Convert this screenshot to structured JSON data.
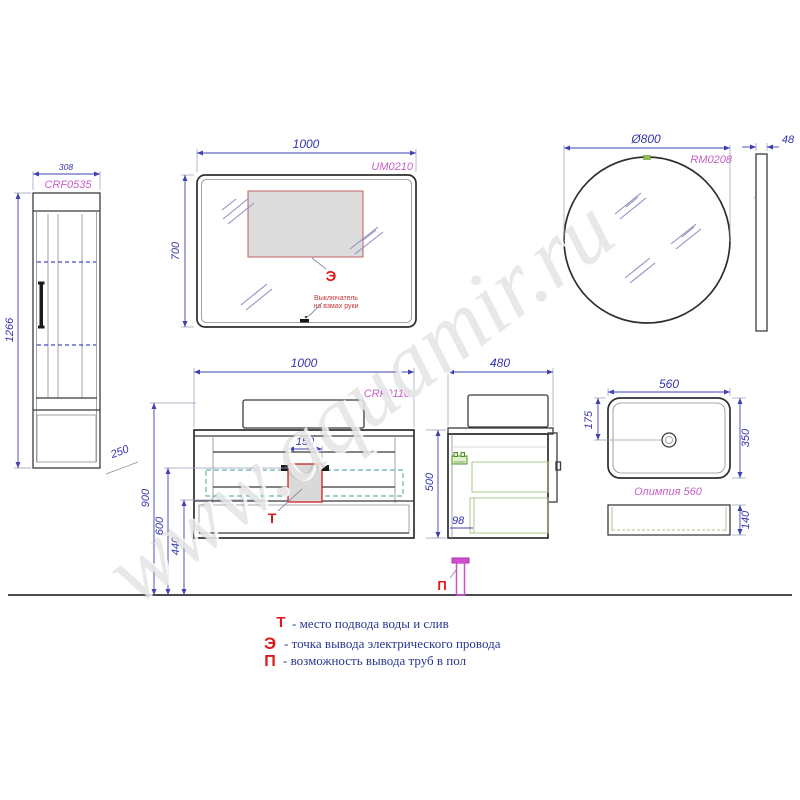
{
  "palette": {
    "line": "#3b3b3b",
    "dimension_blue": "#3434ac",
    "code_magenta": "#c75fc7",
    "marker_red": "#e01818",
    "legend_blue": "#283890",
    "teal_dash": "#62b4b4",
    "green_accent": "#4e8c2e",
    "pipe_magenta": "#cf4fcf"
  },
  "watermark": {
    "text": "www.aquamir.ru"
  },
  "tall_cabinet": {
    "code": "CRF0535",
    "width_label": "308",
    "height_label": "1266",
    "depth_label": "250"
  },
  "flat_mirror": {
    "code": "UM0210",
    "width_label": "1000",
    "height_label": "700",
    "marker": "Э",
    "note_line1": "Выключатель",
    "note_line2": "на взмах руки"
  },
  "round_mirror": {
    "code": "RM0208",
    "diameter_label": "Ø800",
    "depth_label": "48"
  },
  "vanity": {
    "code": "CRF0110",
    "width_label": "1000",
    "cutout_label": "150",
    "h900": "900",
    "h600": "600",
    "h440": "440",
    "marker_water": "Т",
    "depth_label": "480",
    "height_label": "500",
    "gap_label": "98",
    "marker_floor": "П"
  },
  "washbasin": {
    "name": "Олимпия 560",
    "width_label": "560",
    "depth_label": "350",
    "drain_label": "175",
    "height_label": "140"
  },
  "legend": {
    "items": [
      {
        "marker": "Т",
        "text": "- место подвода воды и слив"
      },
      {
        "marker": "Э",
        "text": "- точка вывода электрического провода"
      },
      {
        "marker": "П",
        "text": "- возможность вывода труб в пол"
      }
    ]
  }
}
